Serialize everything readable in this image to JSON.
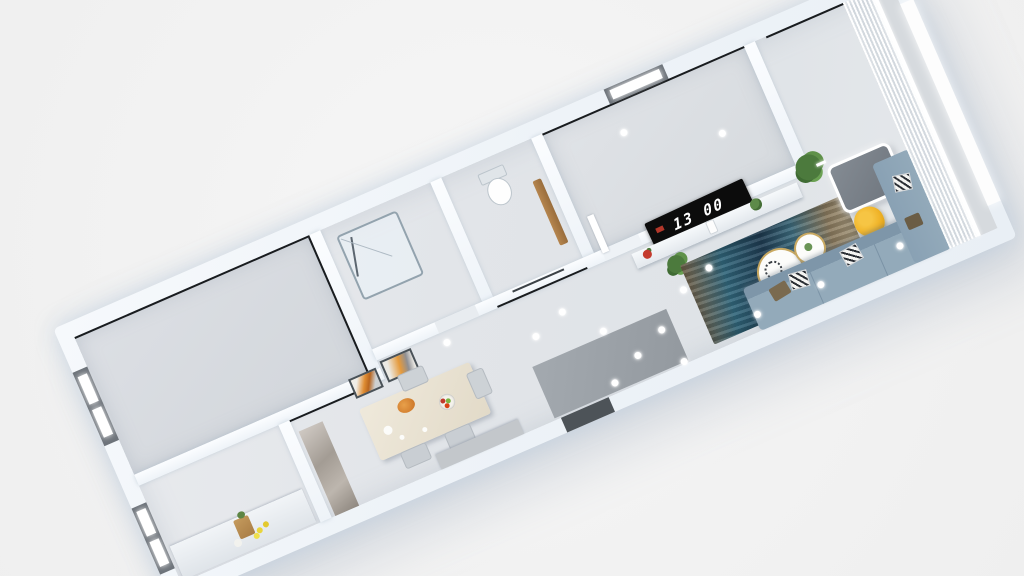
{
  "scene": {
    "type": "3d-apartment-floorplan-render",
    "background_color": "#f2f2f2",
    "tv": {
      "clock_text": "13 00",
      "screen_color": "#0c0c0c",
      "text_color": "#ffffff"
    },
    "selection": {
      "selected_object": "writing-desk",
      "outline_color": "#ffffff"
    },
    "palette": {
      "outer_wall": "#f3f7fb",
      "floor": "#e2e5e9",
      "floor_dark": "#d2d6db",
      "runner_rug": "#9ba1a7",
      "rug_teal": "#31667b",
      "rug_navy": "#1f3c52",
      "rug_brown": "#7d6548",
      "sofa_blue": "#8ca3b6",
      "chair_yellow": "#f0b429",
      "plant_green": "#4c7a3d",
      "wood_door": "#a8743f",
      "art_orange": "#df8d33",
      "dining_table": "#eae3d4",
      "marble_cabinet": "#b3aca4",
      "marker_white": "#ffffff"
    },
    "rooms": [
      "bedroom-large",
      "shower-room",
      "wc",
      "bedroom-small",
      "kitchen",
      "dining-area",
      "hallway",
      "living-room",
      "balcony"
    ],
    "furniture": [
      "tv-clock-screen",
      "media-console",
      "monstera-plant",
      "floor-plant",
      "teal-area-rug",
      "gray-runner-rug",
      "nesting-coffee-tables",
      "yellow-armchair",
      "writing-desk",
      "sectional-sofa",
      "chevron-pillows",
      "dining-table",
      "dining-chairs",
      "fruit-bowl",
      "wall-art-frames",
      "marble-cabinet",
      "sideboard",
      "kitchen-counter",
      "grocery-bag",
      "shower-enclosure",
      "toilet",
      "entry-doorway",
      "interior-door",
      "windows",
      "sheer-curtains"
    ],
    "light_markers": {
      "count": 15,
      "color": "#ffffff"
    }
  }
}
